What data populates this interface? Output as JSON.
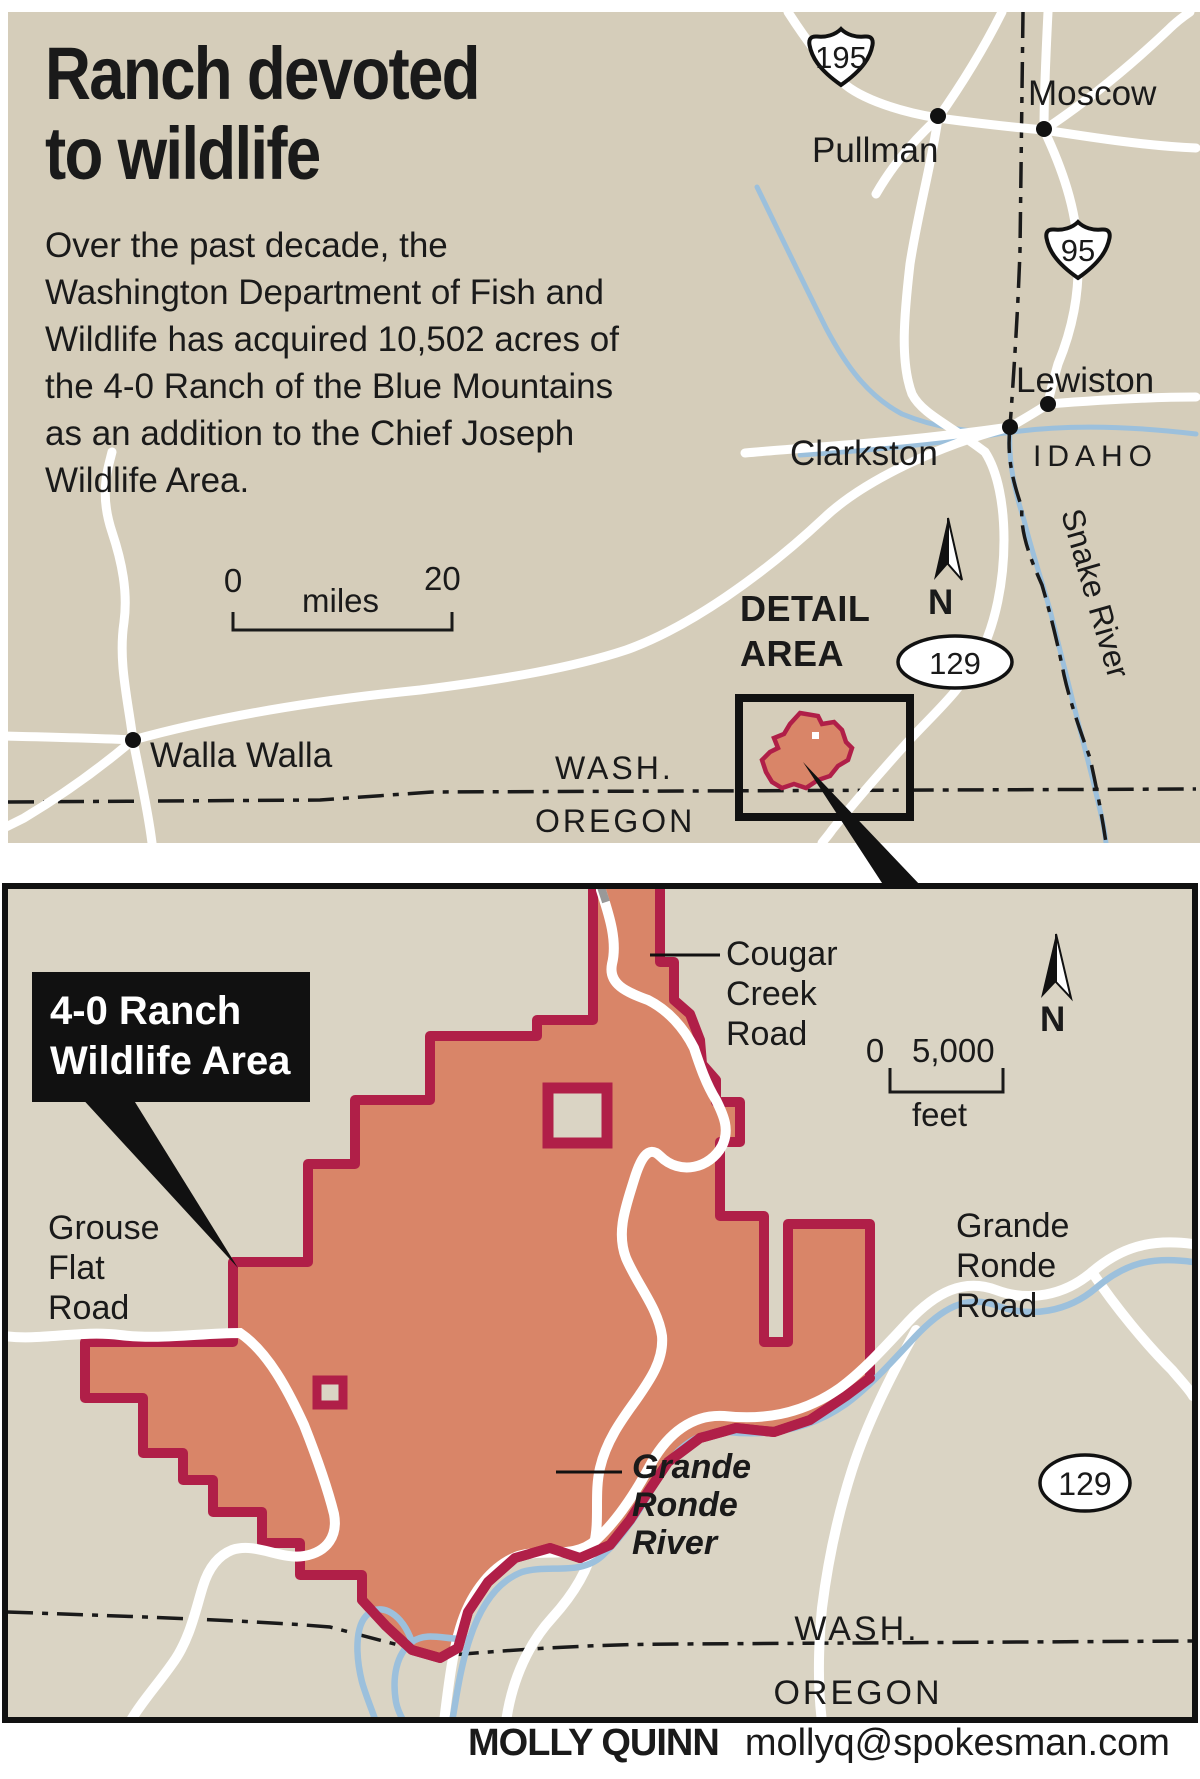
{
  "title": {
    "line1": "Ranch devoted",
    "line2": "to wildlife"
  },
  "intro": {
    "l1": "Over the past decade, the",
    "l2": "Washington Department of Fish and",
    "l3": "Wildlife has acquired 10,502 acres of",
    "l4": "the 4-0 Ranch of the Blue Mountains",
    "l5": "as an addition to the Chief Joseph",
    "l6": "Wildlife Area."
  },
  "locator": {
    "cities": {
      "pullman": "Pullman",
      "moscow": "Moscow",
      "lewiston": "Lewiston",
      "clarkston": "Clarkston",
      "walla_walla": "Walla Walla"
    },
    "states": {
      "idaho": "IDAHO",
      "wash": "WASH.",
      "oregon": "OREGON"
    },
    "river_label": "Snake River",
    "shields": {
      "us195": "195",
      "us95": "95",
      "wa129": "129"
    },
    "scale": {
      "start": "0",
      "unit": "miles",
      "end": "20"
    },
    "detail_area": {
      "line1": "DETAIL",
      "line2": "AREA"
    },
    "compass": "N"
  },
  "detail": {
    "area_label": {
      "line1": "4-0 Ranch",
      "line2": "Wildlife Area"
    },
    "roads": {
      "cougar1": "Cougar",
      "cougar2": "Creek",
      "cougar3": "Road",
      "grouse1": "Grouse",
      "grouse2": "Flat",
      "grouse3": "Road",
      "gronde_road1": "Grande",
      "gronde_road2": "Ronde",
      "gronde_road3": "Road"
    },
    "river": {
      "l1": "Grande",
      "l2": "Ronde",
      "l3": "River"
    },
    "states": {
      "wash": "WASH.",
      "oregon": "OREGON"
    },
    "shield": "129",
    "scale": {
      "start": "0",
      "end": "5,000",
      "unit": "feet"
    },
    "compass": "N"
  },
  "credit": {
    "author": "MOLLY QUINN",
    "email": "mollyq@spokesman.com"
  },
  "colors": {
    "tan_top": "#d5cdba",
    "tan_detail": "#dad4c4",
    "wildlife_fill": "#d98568",
    "wildlife_border": "#b01f48",
    "river_blue": "#9cc0dc",
    "road_white": "#ffffff",
    "ink": "#1a1a1a"
  }
}
